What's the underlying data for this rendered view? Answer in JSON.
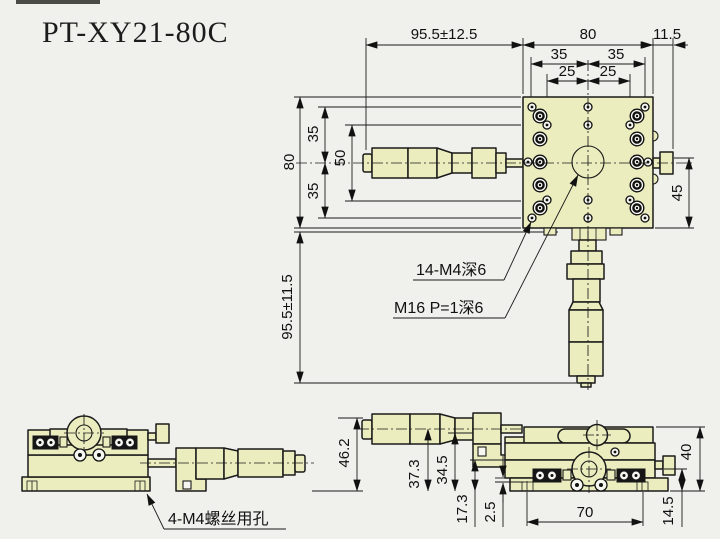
{
  "title": "PT-XY21-80C",
  "colors": {
    "part_fill": "#ecedbe",
    "background": "#f0f0ec",
    "line": "#1a1a1a"
  },
  "top_view": {
    "dim_travel_x": "95.5±12.5",
    "dim_width": "80",
    "dim_knob": "11.5",
    "dim_35_left": "35",
    "dim_35_right": "35",
    "dim_25_left": "25",
    "dim_25_right": "25",
    "dim_height": "80",
    "dim_row35_top": "35",
    "dim_row50": "50",
    "dim_row35_bottom": "35",
    "dim_travel_y": "95.5±11.5",
    "dim_knob_side": "45",
    "label_thread_holes": "14-M4深6",
    "label_center_thread": "M16 P=1深6"
  },
  "front_view": {
    "dim_height": "46.2",
    "label_mount_holes": "4-M4螺丝用孔"
  },
  "side_view": {
    "dim_center_height": "37.3",
    "dim_spindle_height": "34.5",
    "dim_table_height": "17.3",
    "dim_step": "2.5",
    "dim_hole_span": "70",
    "dim_knob_height": "14.5",
    "dim_body_height": "40"
  }
}
